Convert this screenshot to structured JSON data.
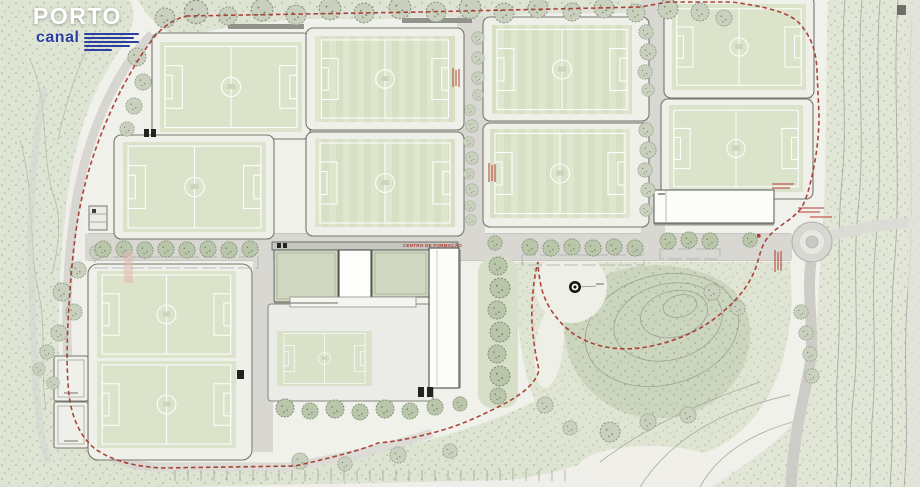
{
  "broadcast": {
    "channel_name": "PORTO",
    "channel_sub_name": "canal",
    "logo_text_color": "#ffffff",
    "logo_accent_color": "#2c3e9f"
  },
  "site_plan": {
    "building_label": "CENTRO DE FORMAÇÃO",
    "boundary_color": "#a83b30",
    "pitch_fill": "#dbe3ca",
    "vegetation_fill": "#dfe5d4",
    "road_fill": "#d8d7d2",
    "full_size_pitch_count": 10,
    "small_pitch_count": 1,
    "features": [
      "football-training-pitches",
      "training-centre-buildings",
      "central-courtyard-pitch",
      "tree-lined-access-roads",
      "roundabout",
      "landscaped-park",
      "contour-terrain",
      "dashed-site-boundary"
    ]
  }
}
